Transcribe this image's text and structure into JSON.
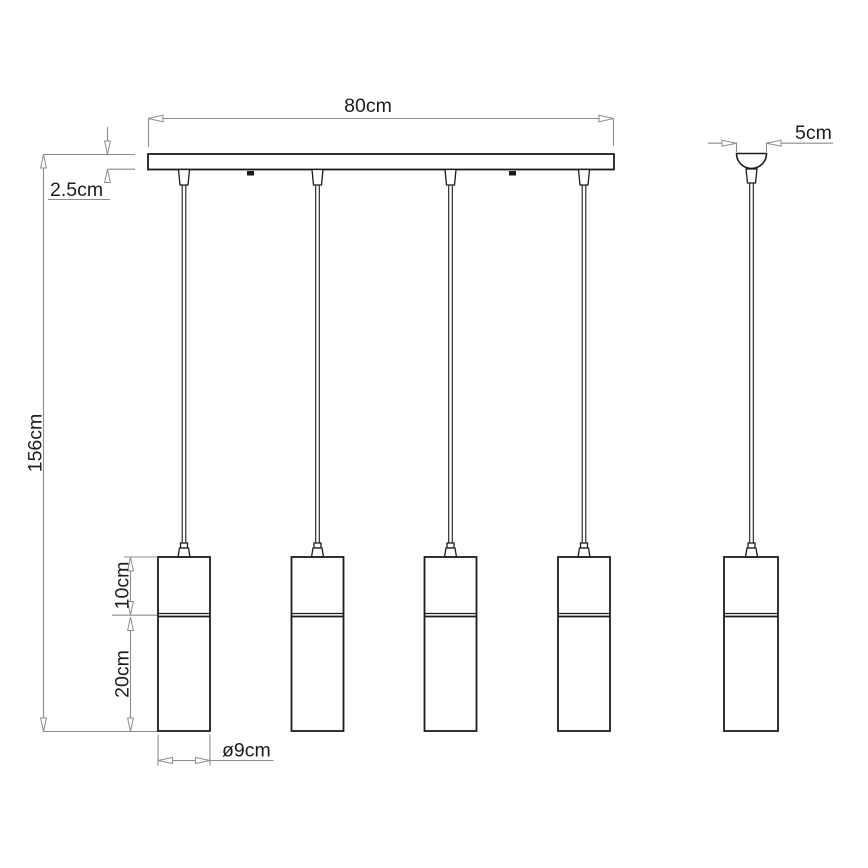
{
  "page": {
    "background": "#ffffff"
  },
  "drawing": {
    "kind": "technical-dimension-drawing",
    "subject": "linear-pendant-light-4-shades-with-side-view",
    "colors": {
      "outline": "#1b1b1b",
      "dimension_lines": "#8c8c8c",
      "label_text": "#1d1d1d",
      "background": "#ffffff"
    },
    "dimensions": {
      "bar_width": "80cm",
      "bar_thickness": "2.5cm",
      "overall_drop": "156cm",
      "shade_upper_section": "10cm",
      "shade_lower_section": "20cm",
      "shade_diameter": "ø9cm",
      "canopy_width": "5cm"
    }
  }
}
